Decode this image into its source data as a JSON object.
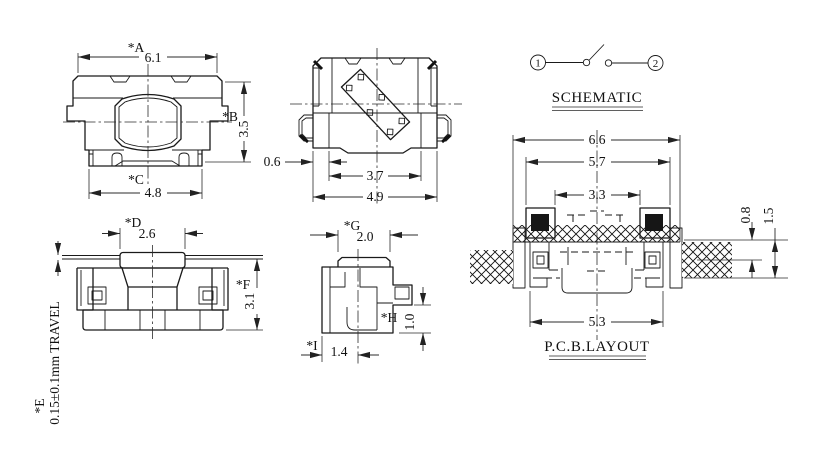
{
  "colors": {
    "background": "#ffffff",
    "line": "#1a1a1a",
    "dimension": "#2b2b2b"
  },
  "top_view": {
    "label_a": "*A",
    "value_a": "6.1",
    "label_b": "*B",
    "value_b": "3.5",
    "label_c": "*C",
    "value_c": "4.8"
  },
  "bottom_view": {
    "value_terminal": "0.6",
    "value_inner": "3.7",
    "value_outer": "4.9"
  },
  "schematic": {
    "title": "SCHEMATIC",
    "pin_left": "1",
    "pin_right": "2"
  },
  "side_view": {
    "label_d": "*D",
    "value_d": "2.6",
    "label_e": "*E",
    "travel_note": "0.15±0.1mm TRAVEL",
    "label_f": "*F",
    "value_f": "3.1"
  },
  "end_view": {
    "label_g": "*G",
    "value_g": "2.0",
    "label_h": "*H",
    "value_h": "1.0",
    "label_i": "*I",
    "value_i": "1.4"
  },
  "pcb_layout": {
    "title": "P.C.B.LAYOUT",
    "value_outer_width": "6.6",
    "value_pad_outer": "5.7",
    "value_pad_inner": "3.3",
    "value_feet_span": "5.3",
    "value_pad_height": "0.8",
    "value_total_height": "1.5"
  }
}
